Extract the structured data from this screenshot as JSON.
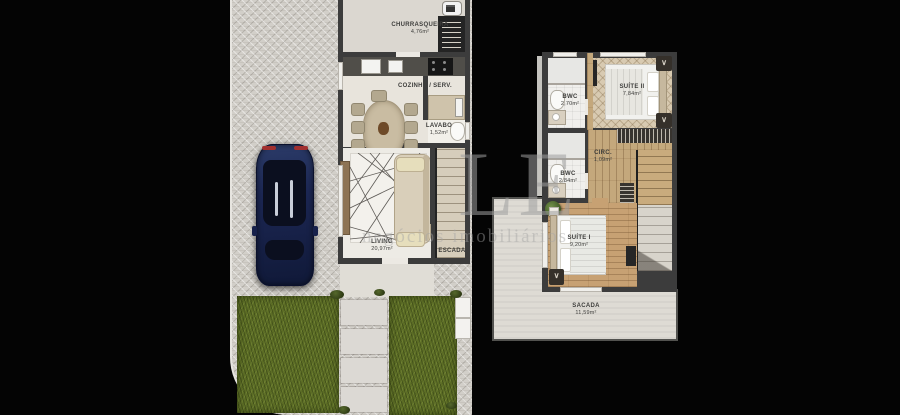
{
  "watermark": {
    "letters": "LE",
    "tagline": "negócios imobiliários"
  },
  "ground_floor": {
    "rooms": [
      {
        "name": "CHURRASQUEIRA",
        "area": "4,76m²"
      },
      {
        "name": "COZINHA / SERV.",
        "area": ""
      },
      {
        "name": "LAVABO",
        "area": "1,52m²"
      },
      {
        "name": "LIVING",
        "area": "20,97m²"
      },
      {
        "name": "ESCADA",
        "area": ""
      }
    ]
  },
  "upper_floor": {
    "rooms": [
      {
        "name": "BWC",
        "area": "2,70m²"
      },
      {
        "name": "SUÍTE II",
        "area": "7,84m²"
      },
      {
        "name": "CIRC.",
        "area": "1,09m²"
      },
      {
        "name": "BWC",
        "area": "2,84m²"
      },
      {
        "name": "SUÍTE I",
        "area": "9,20m²"
      },
      {
        "name": "SACADA",
        "area": "11,59m²"
      }
    ]
  },
  "colors": {
    "background": "#040404",
    "wall": "#3c3c3c",
    "paving": "#d2cfc9",
    "grass": "#5c6d25",
    "wood": "#c4a87c",
    "car_body": "#1c2754",
    "watermark": "#9a9a9a"
  }
}
